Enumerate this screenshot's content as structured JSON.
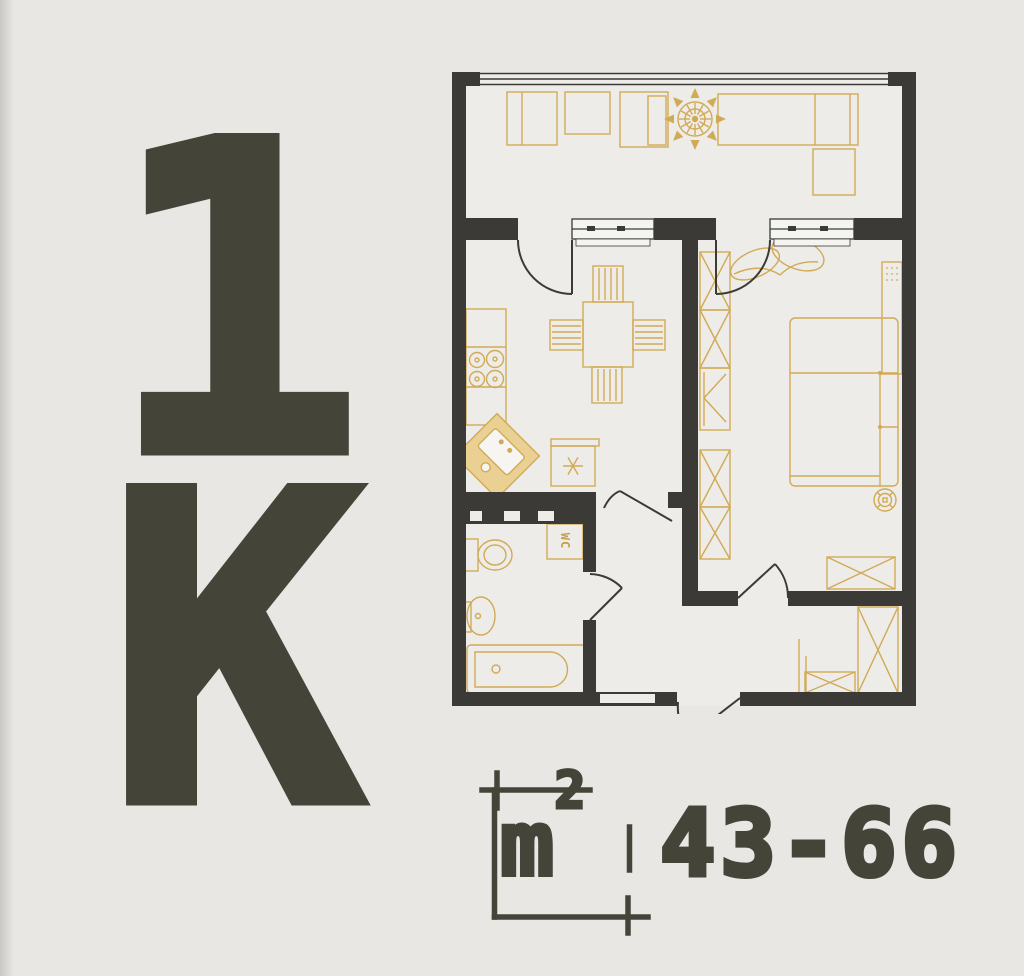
{
  "page": {
    "background": "#e8e7e4"
  },
  "badge": {
    "rooms_count": "1",
    "type_letter": "К"
  },
  "area_label": {
    "unit": "m",
    "sup": "2",
    "range": "43-66"
  },
  "plan": {
    "wc_label": "WC",
    "colors": {
      "wall": "#3b3a36",
      "furniture_line": "#d1aa55",
      "furniture_fill": "#ead193",
      "floor": "#edece9",
      "text": "#454438"
    }
  }
}
